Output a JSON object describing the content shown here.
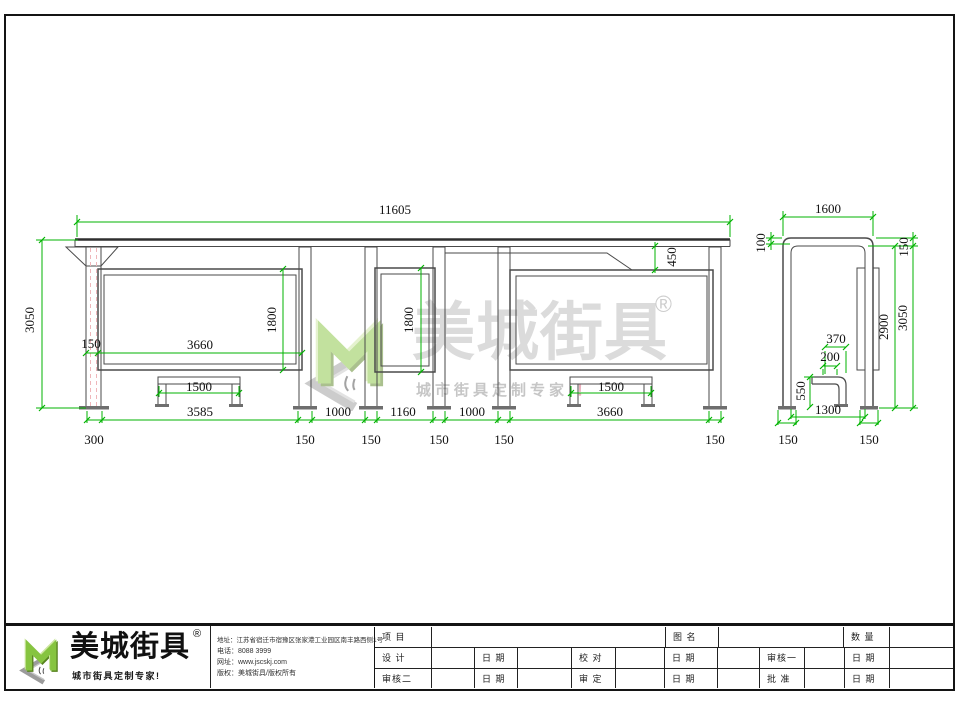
{
  "colors": {
    "dimension_green": "#00b300",
    "line_dark": "#4a4a4a",
    "hidden_line_pink": "#efb6ba",
    "logo_green": "#86c440",
    "watermark_gray": "#dbdbdb"
  },
  "watermark": {
    "brand": "美城街具",
    "registered": "®",
    "tagline": "城市街具定制专家",
    "tagline_mark": "！"
  },
  "dimensions": {
    "front": [
      {
        "text": "11605",
        "x": 395,
        "y": 210
      },
      {
        "text": "3050",
        "x": 30,
        "y": 320,
        "rot": true
      },
      {
        "text": "1800",
        "x": 272,
        "y": 320,
        "rot": true
      },
      {
        "text": "150",
        "x": 91,
        "y": 344
      },
      {
        "text": "3660",
        "x": 200,
        "y": 345
      },
      {
        "text": "1500",
        "x": 199,
        "y": 387
      },
      {
        "text": "3585",
        "x": 200,
        "y": 412
      },
      {
        "text": "1800",
        "x": 409,
        "y": 320,
        "rot": true
      },
      {
        "text": "1000",
        "x": 338,
        "y": 412
      },
      {
        "text": "1160",
        "x": 403,
        "y": 412
      },
      {
        "text": "1000",
        "x": 472,
        "y": 412
      },
      {
        "text": "450",
        "x": 672,
        "y": 257,
        "rot": true
      },
      {
        "text": "1500",
        "x": 611,
        "y": 387
      },
      {
        "text": "3660",
        "x": 610,
        "y": 412
      },
      {
        "text": "300",
        "x": 94,
        "y": 440
      },
      {
        "text": "150",
        "x": 305,
        "y": 440
      },
      {
        "text": "150",
        "x": 371,
        "y": 440
      },
      {
        "text": "150",
        "x": 439,
        "y": 440
      },
      {
        "text": "150",
        "x": 504,
        "y": 440
      },
      {
        "text": "150",
        "x": 715,
        "y": 440
      }
    ],
    "side": [
      {
        "text": "1600",
        "x": 828,
        "y": 209
      },
      {
        "text": "100",
        "x": 761,
        "y": 243,
        "rot": true
      },
      {
        "text": "150",
        "x": 904,
        "y": 247,
        "rot": true
      },
      {
        "text": "2900",
        "x": 884,
        "y": 327,
        "rot": true
      },
      {
        "text": "3050",
        "x": 903,
        "y": 318,
        "rot": true
      },
      {
        "text": "370",
        "x": 836,
        "y": 339
      },
      {
        "text": "200",
        "x": 830,
        "y": 357
      },
      {
        "text": "550",
        "x": 801,
        "y": 391,
        "rot": true
      },
      {
        "text": "1300",
        "x": 828,
        "y": 410
      },
      {
        "text": "150",
        "x": 788,
        "y": 440
      },
      {
        "text": "150",
        "x": 869,
        "y": 440
      }
    ]
  },
  "title_block": {
    "logo": {
      "brand": "美城街具",
      "registered": "®",
      "tagline": "城市街具定制专家!"
    },
    "contact": {
      "address": "地址：江苏省宿迁市宿豫区张家港工业园区南丰路西侧1号",
      "phone": "电话：8088 3999",
      "website": "网址：www.jscskj.com",
      "copyright": "版权：美城街具/版权所有"
    },
    "table": {
      "rows": [
        [
          "项 目",
          "",
          "图 名",
          "",
          "数 量",
          ""
        ],
        [
          "设 计",
          "",
          "日 期",
          "",
          "校 对",
          "",
          "日 期",
          "",
          "审核一",
          "",
          "日 期",
          ""
        ],
        [
          "审核二",
          "",
          "日 期",
          "",
          "审 定",
          "",
          "日 期",
          "",
          "批 准",
          "",
          "日 期",
          ""
        ]
      ]
    }
  }
}
